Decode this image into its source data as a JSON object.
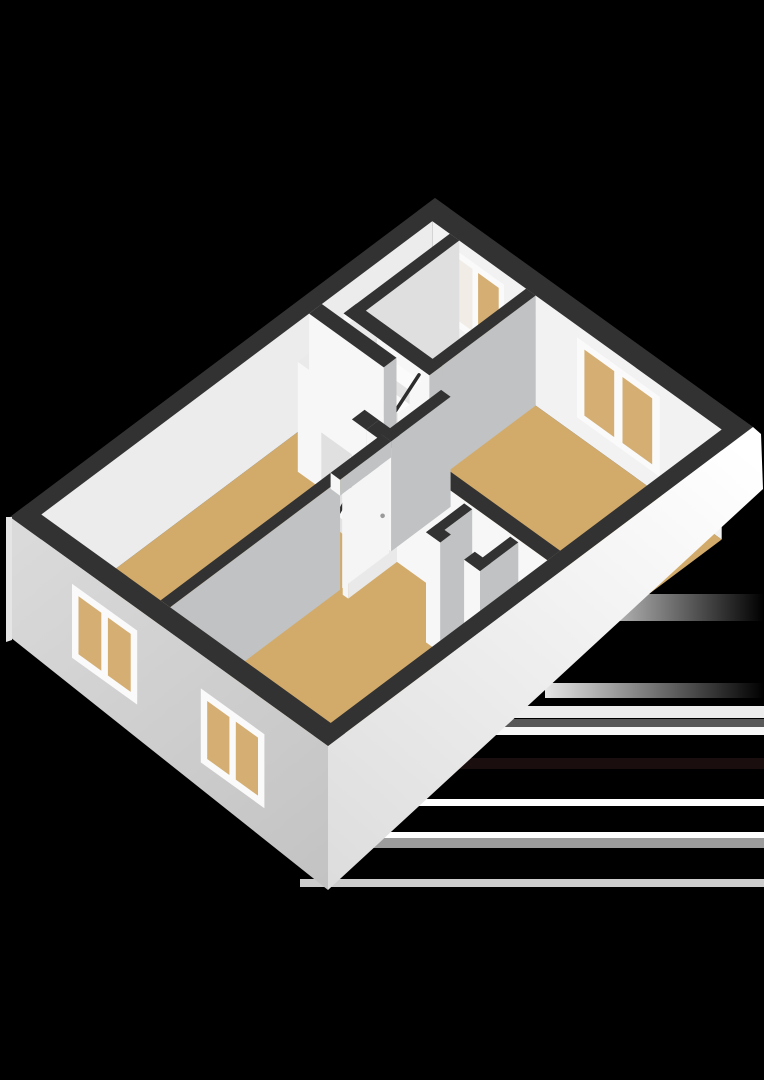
{
  "image": {
    "kind": "3d-floorplan-render",
    "background": "#000000"
  },
  "colors": {
    "background": "#000000",
    "wall_top": "#323232",
    "face_white": "#f7f7f7",
    "face_white_dim": "#efefef",
    "face_gray": "#c0c2c3",
    "face_gray_light": "#dfdfdf",
    "ne_face": "#f2f2f2",
    "nw_face": "#ececec",
    "ext_sw_light": "#dadada",
    "ext_sw_dark": "#c3c3c3",
    "ext_se_light": "#ffffff",
    "ext_se_dark": "#dddddd",
    "floor_tan": "#d2ab6b",
    "floor_void": "#f4f4f4",
    "closet_floor": "#ededed",
    "glass_tan": "#d4ae73",
    "glass_light": "#f1ece5",
    "window_frame": "#fafafa",
    "handrail": "#2c2c2c",
    "step_top": "#fbfbfb",
    "step_riser": "#e3e3e3",
    "box_top": "#eaeaea",
    "box_face_light": "#f7f7f7",
    "box_face_mid": "#e0e0e0",
    "door_white": "#f5f5f5",
    "door_handle": "#9a9a9a",
    "corner_edge": "#e5e5e5"
  },
  "artifacts": {
    "stripes": [
      {
        "y": 706,
        "h": 12,
        "color": "#fafafa",
        "opacity": 0.95
      },
      {
        "y": 719,
        "h": 8,
        "color": "#585858",
        "opacity": 1
      },
      {
        "y": 727,
        "h": 8,
        "color": "#f7f7f7",
        "opacity": 1
      },
      {
        "y": 758,
        "h": 11,
        "color": "#1a0e0e",
        "opacity": 1
      },
      {
        "y": 799,
        "h": 7,
        "color": "#ffffff",
        "opacity": 1
      },
      {
        "y": 832,
        "h": 6,
        "color": "#ffffff",
        "opacity": 1
      },
      {
        "y": 838,
        "h": 10,
        "color": "#9c9c9c",
        "opacity": 1
      },
      {
        "y": 879,
        "h": 8,
        "color": "#cdcdcd",
        "opacity": 1
      }
    ],
    "glows": [
      {
        "y": 594,
        "h": 27,
        "x": 575
      },
      {
        "y": 683,
        "h": 15,
        "x": 545
      }
    ]
  },
  "scene": {
    "elements": [
      "exterior-walls",
      "interior-walls",
      "tan-floors",
      "winder-staircase",
      "stair-handrail",
      "stair-closet",
      "storage-closet",
      "top-room-window",
      "right-room-window",
      "facade-window-upper",
      "facade-window-lower",
      "left-room-doorway",
      "right-room-door",
      "living-room-door",
      "render-artifact-stripes"
    ]
  }
}
